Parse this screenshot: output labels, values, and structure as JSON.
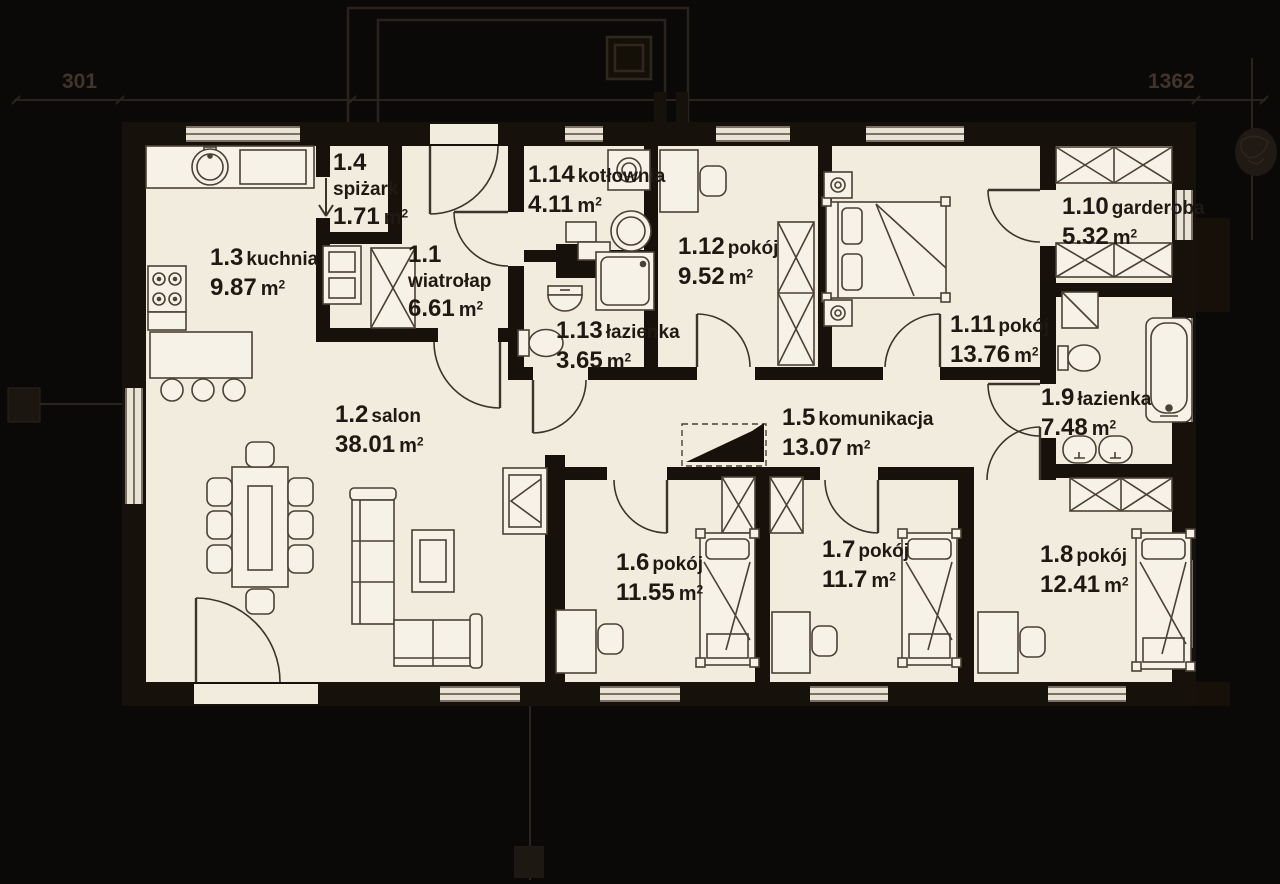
{
  "plan_title": "rzut parteru",
  "rooms": {
    "wiatrolap": {
      "num": "1.1",
      "name": "wiatrołap",
      "area": "6.61",
      "unit": "m",
      "sup": "2"
    },
    "salon": {
      "num": "1.2",
      "name": "salon",
      "area": "38.01",
      "unit": "m",
      "sup": "2"
    },
    "kuchnia": {
      "num": "1.3",
      "name": "kuchnia",
      "area": "9.87",
      "unit": "m",
      "sup": "2"
    },
    "spizarka": {
      "num": "1.4",
      "name": "spiżark",
      "area": "1.71",
      "unit": "m",
      "sup": "2"
    },
    "komunikacja": {
      "num": "1.5",
      "name": "komunikacja",
      "area": "13.07",
      "unit": "m",
      "sup": "2"
    },
    "pokoj6": {
      "num": "1.6",
      "name": "pokój",
      "area": "11.55",
      "unit": "m",
      "sup": "2"
    },
    "pokoj7": {
      "num": "1.7",
      "name": "pokój",
      "area": "11.7",
      "unit": "m",
      "sup": "2"
    },
    "pokoj8": {
      "num": "1.8",
      "name": "pokój",
      "area": "12.41",
      "unit": "m",
      "sup": "2"
    },
    "lazienka9": {
      "num": "1.9",
      "name": "łazienka",
      "area": "7.48",
      "unit": "m",
      "sup": "2"
    },
    "garderoba": {
      "num": "1.10",
      "name": "garderoba",
      "area": "5.32",
      "unit": "m",
      "sup": "2"
    },
    "pokoj11": {
      "num": "1.11",
      "name": "pokój",
      "area": "13.76",
      "unit": "m",
      "sup": "2"
    },
    "pokoj12": {
      "num": "1.12",
      "name": "pokój",
      "area": "9.52",
      "unit": "m",
      "sup": "2"
    },
    "lazienka13": {
      "num": "1.13",
      "name": "łazienka",
      "area": "3.65",
      "unit": "m",
      "sup": "2"
    },
    "kotlownia": {
      "num": "1.14",
      "name": "kotłownia",
      "area": "4.11",
      "unit": "m",
      "sup": "2"
    }
  },
  "dimensions": {
    "top_left": "301",
    "top_right": "1362"
  },
  "colors": {
    "background": "#0b0908",
    "wall": "#17110b",
    "floor": "#f2ecdf",
    "line": "#46three",
    "text": "#1f1913"
  }
}
